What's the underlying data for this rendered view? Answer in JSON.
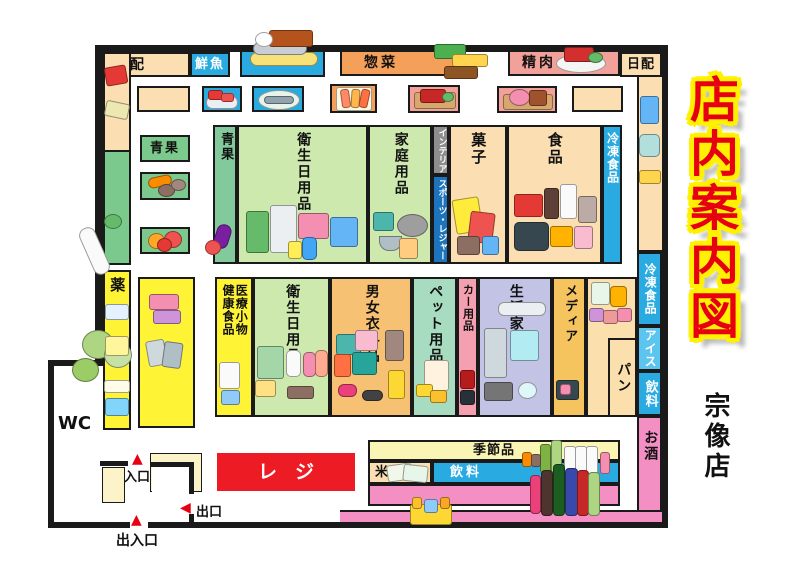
{
  "title": {
    "main": "店内案内図",
    "store_name": "宗像店"
  },
  "icons": {
    "up_triangle": "▲",
    "left_triangle": "◀"
  },
  "sections": {
    "top_row": {
      "nippai_left": "日配",
      "fresh_fish": "鮮魚",
      "deli": "惣菜",
      "meat": "精肉",
      "nippai_right": "日配"
    },
    "left_col": {
      "produce_box": "青果",
      "medicine": "薬"
    },
    "block1": {
      "produce_strip": "青果",
      "hygiene": "衛生日用品",
      "household": "家庭用品",
      "interior": "インテリア",
      "sports_leisure": "スポーツ・レジャー",
      "sweets": "菓子",
      "food": "食品",
      "frozen": "冷凍食品"
    },
    "block2": {
      "medical_goods": "医療小物",
      "health_food": "健康食品",
      "hygiene": "衛生日用品",
      "clothing": "男女衣料品",
      "pet": "ペット用品",
      "car": "カー用品",
      "appliances": "生活家電",
      "media": "メディア",
      "bread": "パン"
    },
    "right_col": {
      "frozen": "冷凍食品",
      "ice_cream": "アイス",
      "beverage": "飲料",
      "alcohol": "お酒"
    },
    "bottom_area": {
      "seasonal": "季節品",
      "rice": "米",
      "beverage": "飲料",
      "register": "レジ"
    },
    "facilities": {
      "toilet": "WC",
      "entrance": "入口",
      "exit": "出口",
      "main_entrance": "出入口"
    }
  },
  "colors": {
    "title_red": "#E60012",
    "title_outline_yellow": "#FFF100",
    "register_red": "#ED1C24",
    "frozen_blue": "#29ABE2",
    "ice_light_blue": "#5BC5EF",
    "alcohol_pink": "#F48FC3",
    "medicine_yellow": "#FFF335",
    "dairy_beige": "#FBDFB2",
    "hygiene_light_green": "#CDE9AE",
    "produce_green": "#7CC98E",
    "deli_orange": "#F5A05A",
    "meat_salmon": "#F2A09A",
    "clothing_orange": "#F7C173",
    "pet_mint": "#A8DCC0",
    "car_pink": "#F5A0B0",
    "appliance_lavender": "#C3C3E6",
    "media_gold": "#F5C45E",
    "seasonal_pale_yellow": "#FBF5B5",
    "sports_blue": "#1C75BC",
    "interior_gray": "#8E8E8E",
    "wall_black": "#1A1A1A"
  }
}
